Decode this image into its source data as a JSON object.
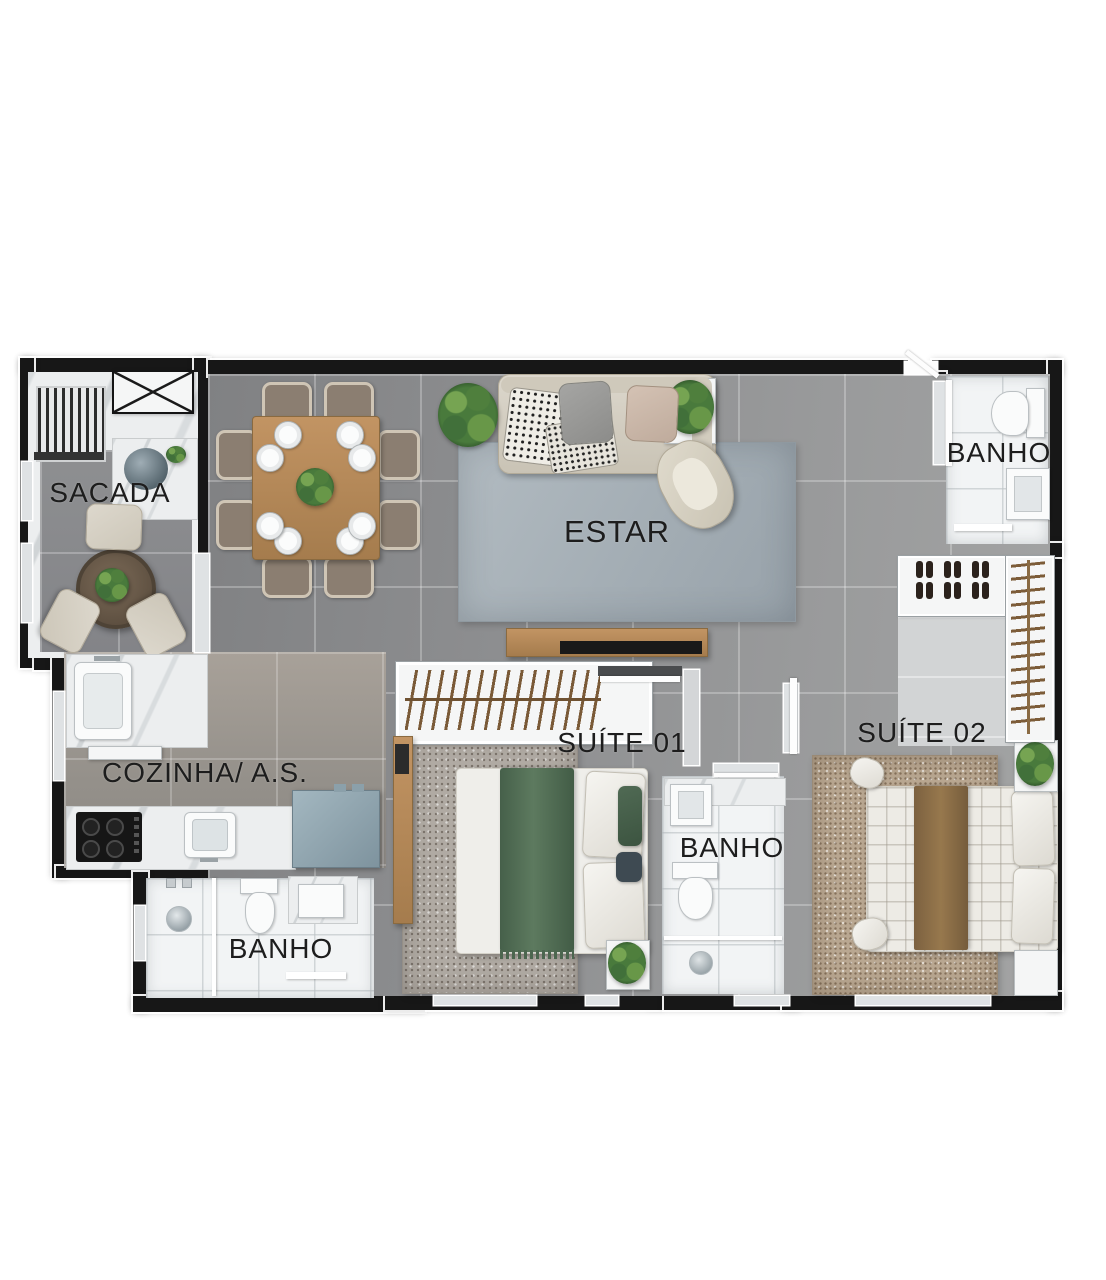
{
  "floorplan": {
    "labels": {
      "sacada": "SACADA",
      "estar": "ESTAR",
      "cozinha_as": "COZINHA/ A.S.",
      "suite_01": "SUÍTE 01",
      "suite_02": "SUÍTE 02",
      "banho_top_right": "BANHO",
      "banho_middle": "BANHO",
      "banho_bottom_left": "BANHO"
    },
    "colors": {
      "background": "#ffffff",
      "wall": "#171717",
      "wall_lining": "#ffffff",
      "floor_main": "#919293",
      "floor_kitchen": "#a19a92",
      "floor_bath": "#f2f4f5",
      "marble": "#eceeef",
      "rug_estar": "#a9b2b8",
      "rug_suite1": "#b0aaa3",
      "rug_suite2": "#b9a791",
      "wood": "#b78c5c",
      "hanger_wood": "#7a5a37",
      "appliance_blue": "#93a8b2",
      "plant_green": "#497a3c",
      "textile_green": "#55705a",
      "textile_brown": "#8d6f46",
      "sofa_cream": "#d9d4c9",
      "label_text": "#1d1d1d"
    }
  }
}
